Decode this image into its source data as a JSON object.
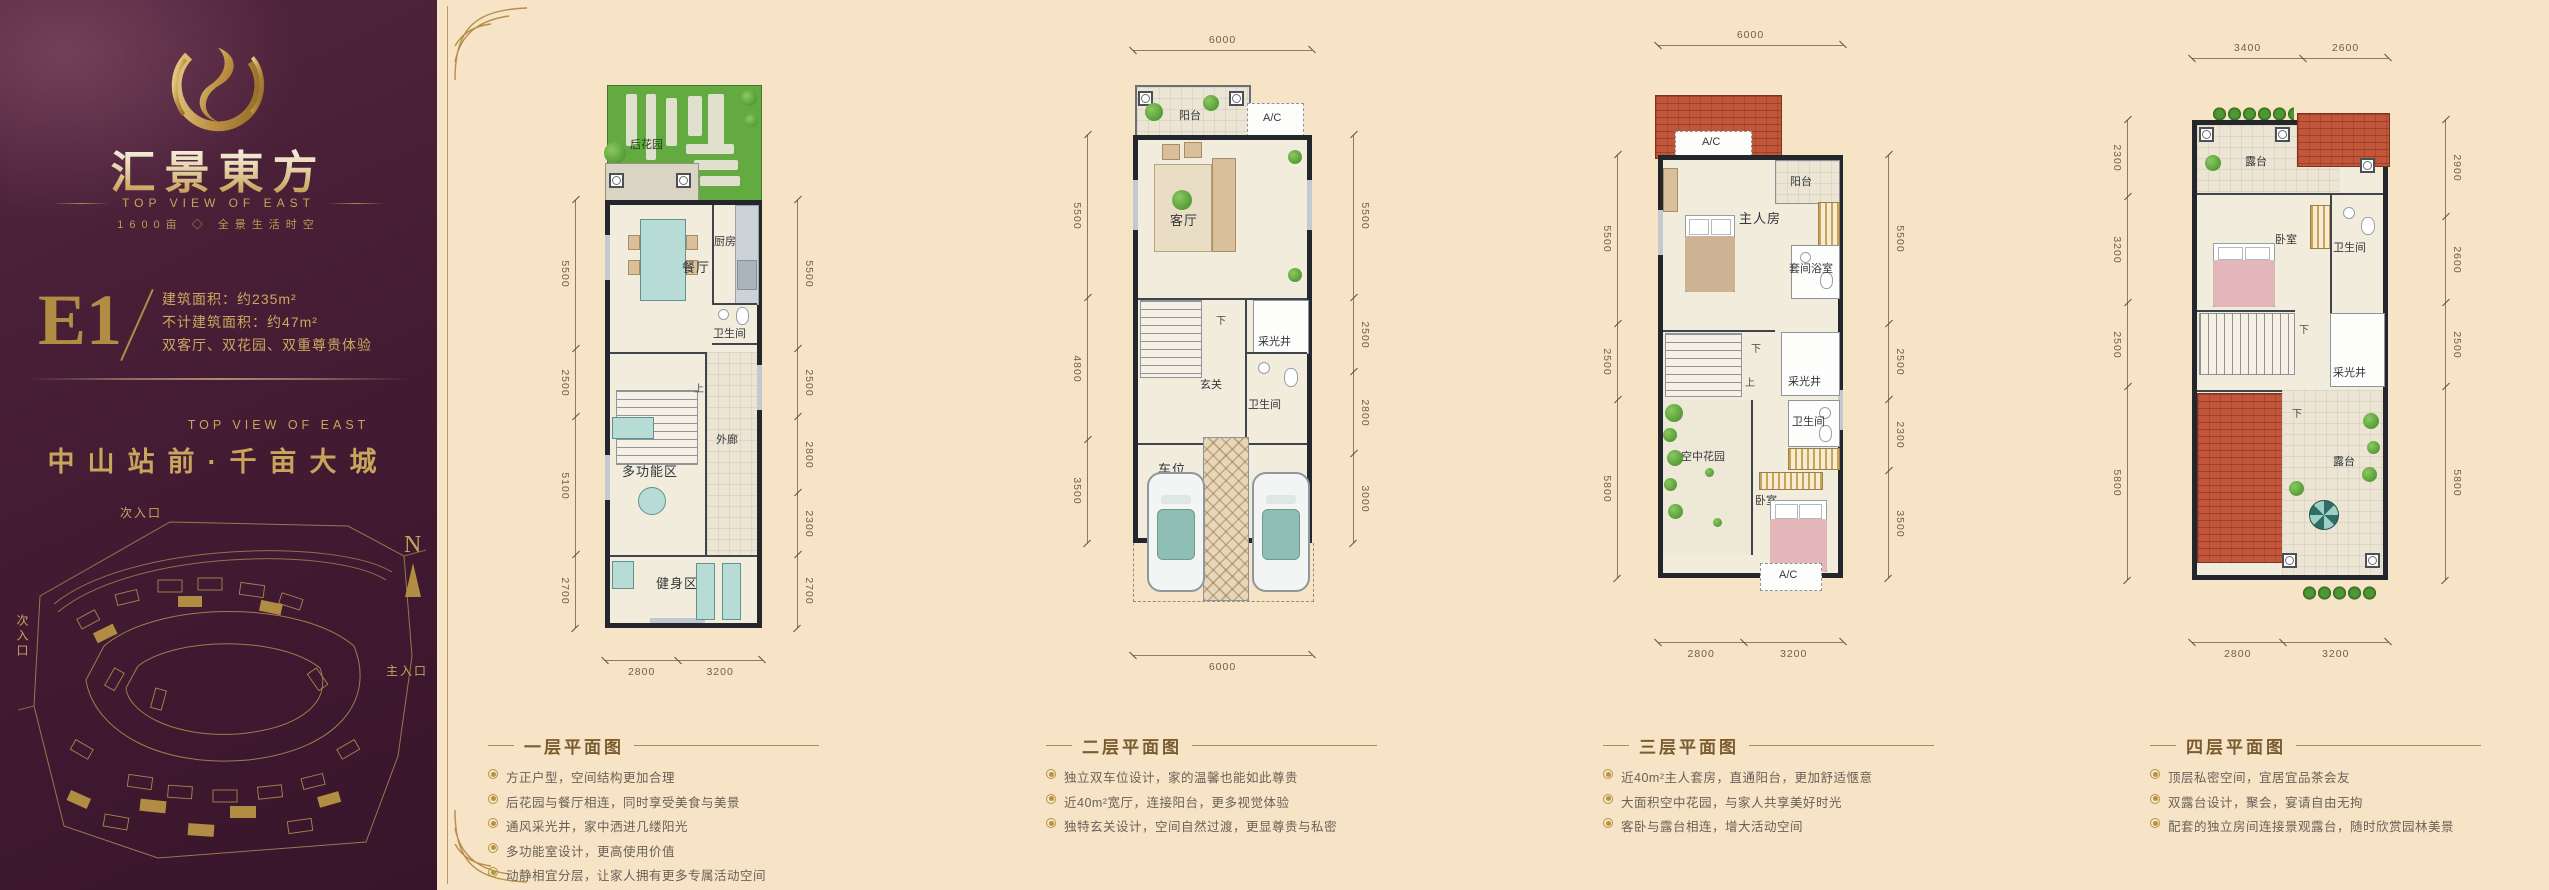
{
  "colors": {
    "accent_gold": "#c9a45c",
    "sidebar_purple": "#441c34",
    "canvas_beige": "#f7e3c6",
    "roof_red": "#c2563b",
    "garden_green": "#63ab41"
  },
  "sidebar": {
    "brand": "汇景東方",
    "brand_en": "TOP VIEW OF EAST",
    "tagline": "1600亩 ◇ 全景生活时空",
    "unit_code": "E1",
    "area1": "建筑面积：约235m²",
    "area2": "不计建筑面积：约47m²",
    "features": "双客厅、双花园、双重尊贵体验",
    "slogan_en": "TOP VIEW OF EAST",
    "slogan": "中山站前·千亩大城",
    "map": {
      "north": "N",
      "entry_top": "次入口",
      "entry_left": "次入口",
      "entry_main": "主入口"
    }
  },
  "floors": [
    {
      "title": "一层平面图",
      "bullets": [
        "方正户型，空间结构更加合理",
        "后花园与餐厅相连，同时享受美食与美景",
        "通风采光井，家中洒进几缕阳光",
        "多功能室设计，更高使用价值",
        "动静相宜分层，让家人拥有更多专属活动空间"
      ],
      "rooms": {
        "garden": "后花园",
        "dining": "餐厅",
        "kitchen": "厨房",
        "bath": "卫生间",
        "view": "景观",
        "up": "上",
        "corridor": "外廊",
        "multi": "多功能区",
        "gym": "健身区"
      },
      "dims": {
        "left": [
          "5500",
          "2500",
          "5100",
          "2700"
        ],
        "right": [
          "5500",
          "2500",
          "2800",
          "2300",
          "2700"
        ],
        "bottom": [
          "2800",
          "3200"
        ]
      }
    },
    {
      "title": "二层平面图",
      "bullets": [
        "独立双车位设计，家的温馨也能如此尊贵",
        "近40m²宽厅，连接阳台，更多视觉体验",
        "独特玄关设计，空间自然过渡，更显尊贵与私密"
      ],
      "rooms": {
        "balcony": "阳台",
        "ac": "A/C",
        "living": "客厅",
        "down": "下",
        "lightwell": "采光井",
        "foyer": "玄关",
        "bath": "卫生间",
        "parking": "车位"
      },
      "dims": {
        "top": [
          "6000"
        ],
        "left": [
          "5500",
          "4800",
          "3500"
        ],
        "right": [
          "5500",
          "2500",
          "2800",
          "3000"
        ],
        "bottom": [
          "6000"
        ]
      }
    },
    {
      "title": "三层平面图",
      "bullets": [
        "近40m²主人套房，直通阳台，更加舒适惬意",
        "大面积空中花园，与家人共享美好时光",
        "客卧与露台相连，增大活动空间"
      ],
      "rooms": {
        "ac": "A/C",
        "balcony": "阳台",
        "master": "主人房",
        "suite_bath": "套间浴室",
        "down": "下",
        "up": "上",
        "lightwell": "采光井",
        "bath": "卫生间",
        "sky_garden": "空中花园",
        "bedroom": "卧室",
        "ac2": "A/C"
      },
      "dims": {
        "top": [
          "6000"
        ],
        "left": [
          "5500",
          "2500",
          "5800"
        ],
        "right": [
          "5500",
          "2500",
          "2300",
          "3500"
        ],
        "bottom": [
          "2800",
          "3200"
        ]
      }
    },
    {
      "title": "四层平面图",
      "bullets": [
        "顶层私密空间，宜居宜品茶会友",
        "双露台设计，聚会，宴请自由无拘",
        "配套的独立房间连接景观露台，随时欣赏园林美景"
      ],
      "rooms": {
        "terrace": "露台",
        "bedroom": "卧室",
        "bath": "卫生间",
        "lightwell": "采光井",
        "down": "下",
        "terrace2": "露台"
      },
      "dims": {
        "top": [
          "3400",
          "2600"
        ],
        "left": [
          "2300",
          "3200",
          "2500",
          "5800"
        ],
        "right": [
          "2900",
          "2600",
          "2500",
          "5800"
        ],
        "bottom": [
          "2800",
          "3200"
        ]
      }
    }
  ]
}
